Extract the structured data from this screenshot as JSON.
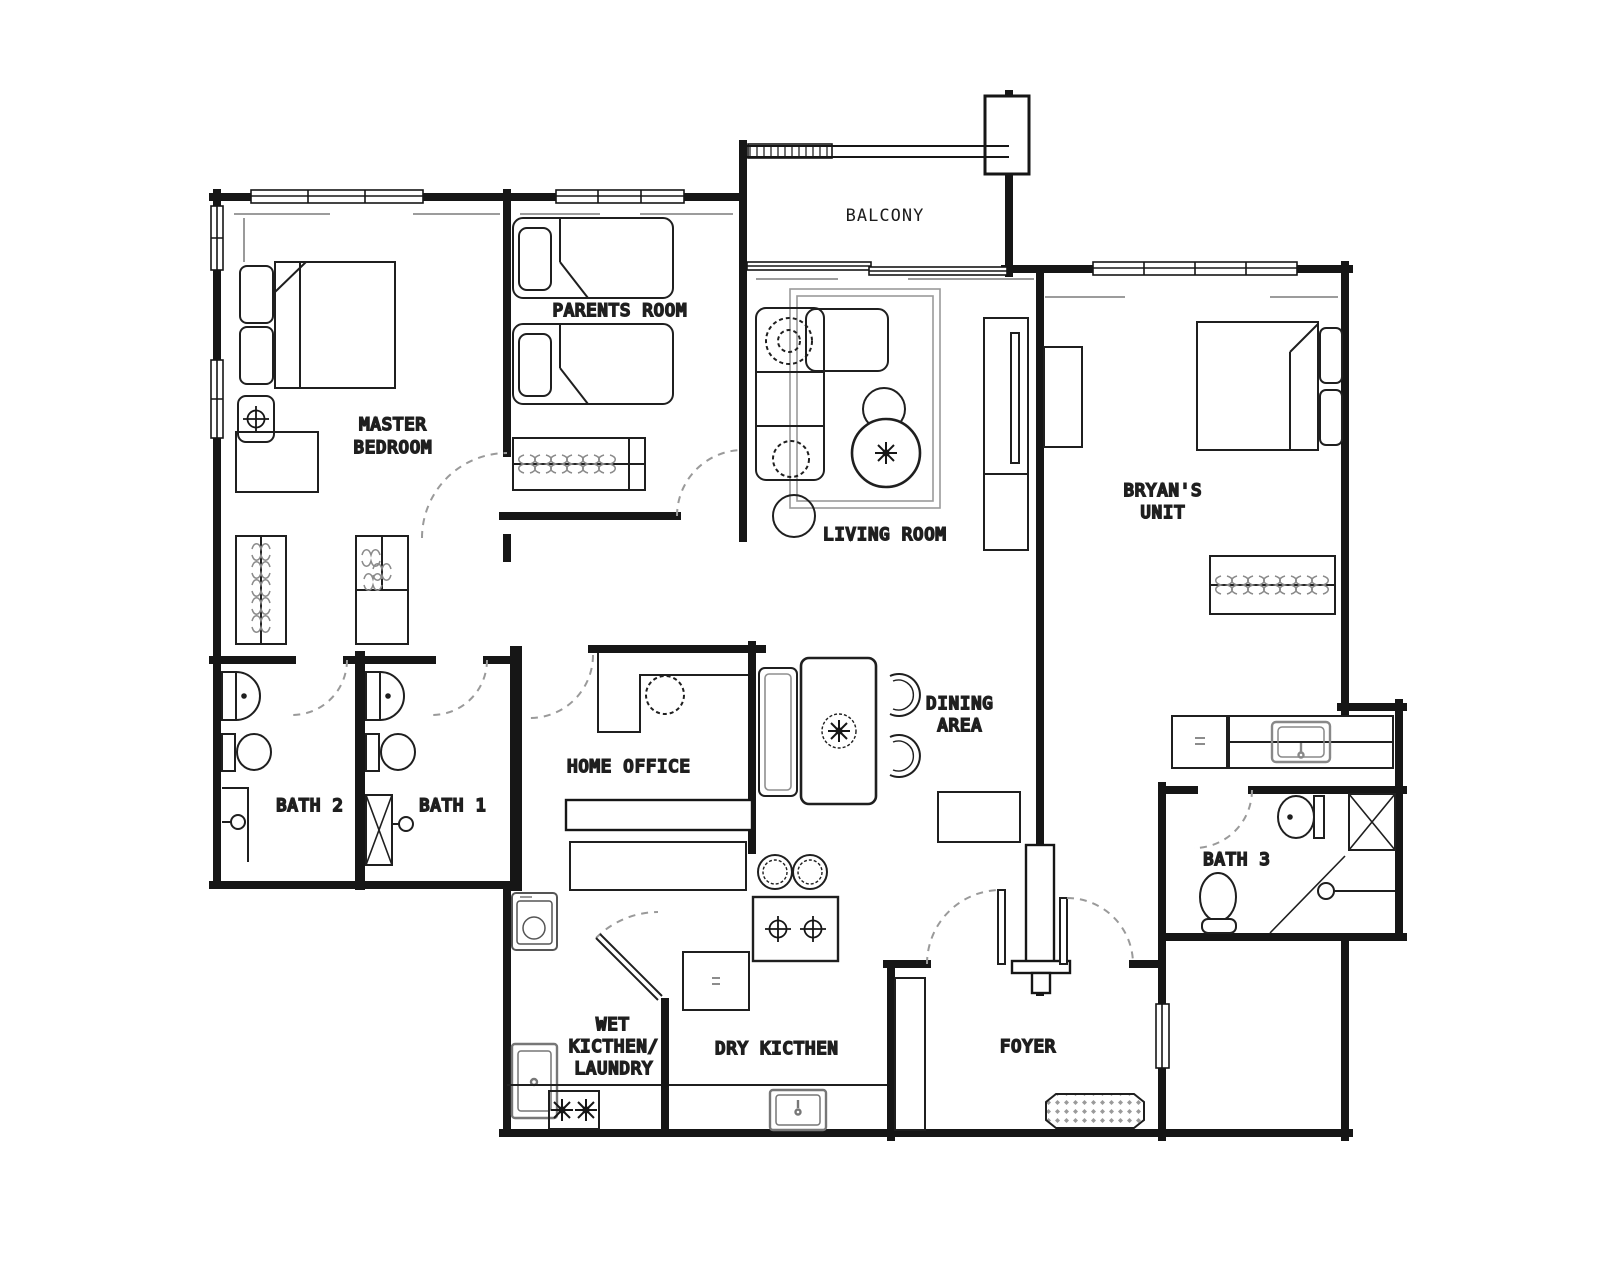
{
  "plan": {
    "type": "apartment-floor-plan",
    "background": "#ffffff",
    "wall_color": "#161616",
    "soft_line_color": "#8f8f8f",
    "door_swing_color": "#9a9a9a"
  },
  "rooms": {
    "balcony": {
      "label": "BALCONY"
    },
    "parents_room": {
      "label": "PARENTS ROOM"
    },
    "master_bedroom": {
      "line1": "MASTER",
      "line2": "BEDROOM"
    },
    "living_room": {
      "label": "LIVING ROOM"
    },
    "bryans_unit": {
      "line1": "BRYAN'S",
      "line2": "UNIT"
    },
    "dining_area": {
      "line1": "DINING",
      "line2": "AREA"
    },
    "home_office": {
      "label": "HOME OFFICE"
    },
    "bath_1": {
      "label": "BATH 1"
    },
    "bath_2": {
      "label": "BATH 2"
    },
    "bath_3": {
      "label": "BATH 3"
    },
    "wet_kitchen": {
      "line1": "WET",
      "line2": "KICTHEN/",
      "line3": "LAUNDRY"
    },
    "dry_kitchen": {
      "label": "DRY KICTHEN"
    },
    "foyer": {
      "label": "FOYER"
    }
  },
  "furniture": {
    "master_bedroom": [
      "double-bed",
      "pillows",
      "nightstand-lamp",
      "dresser",
      "wardrobe",
      "wardrobe"
    ],
    "parents_room": [
      "single-bed",
      "single-bed",
      "wardrobe"
    ],
    "living_room": [
      "l-sofa",
      "plants",
      "side-table",
      "stool",
      "round-coffee-table",
      "tv-console",
      "rug",
      "cabinet"
    ],
    "bryans_unit": [
      "double-bed",
      "tv-console",
      "wardrobe",
      "fridge",
      "kitchenette-counter",
      "sink"
    ],
    "dining_area": [
      "dining-table",
      "bench",
      "chair",
      "chair",
      "bar-stool",
      "bar-stool",
      "island-hob",
      "cabinet"
    ],
    "home_office": [
      "desk",
      "office-chair"
    ],
    "bath_1": [
      "vanity-sink",
      "toilet",
      "shower",
      "duct"
    ],
    "bath_2": [
      "vanity-sink",
      "toilet",
      "shower"
    ],
    "bath_3": [
      "vanity-sink",
      "toilet",
      "shower",
      "duct"
    ],
    "wet_kitchen": [
      "washing-machine",
      "sink",
      "hob",
      "counter"
    ],
    "dry_kitchen": [
      "fridge",
      "sink",
      "counter"
    ],
    "foyer": [
      "shoe-cabinet",
      "doormat",
      "double-entry-door"
    ]
  }
}
